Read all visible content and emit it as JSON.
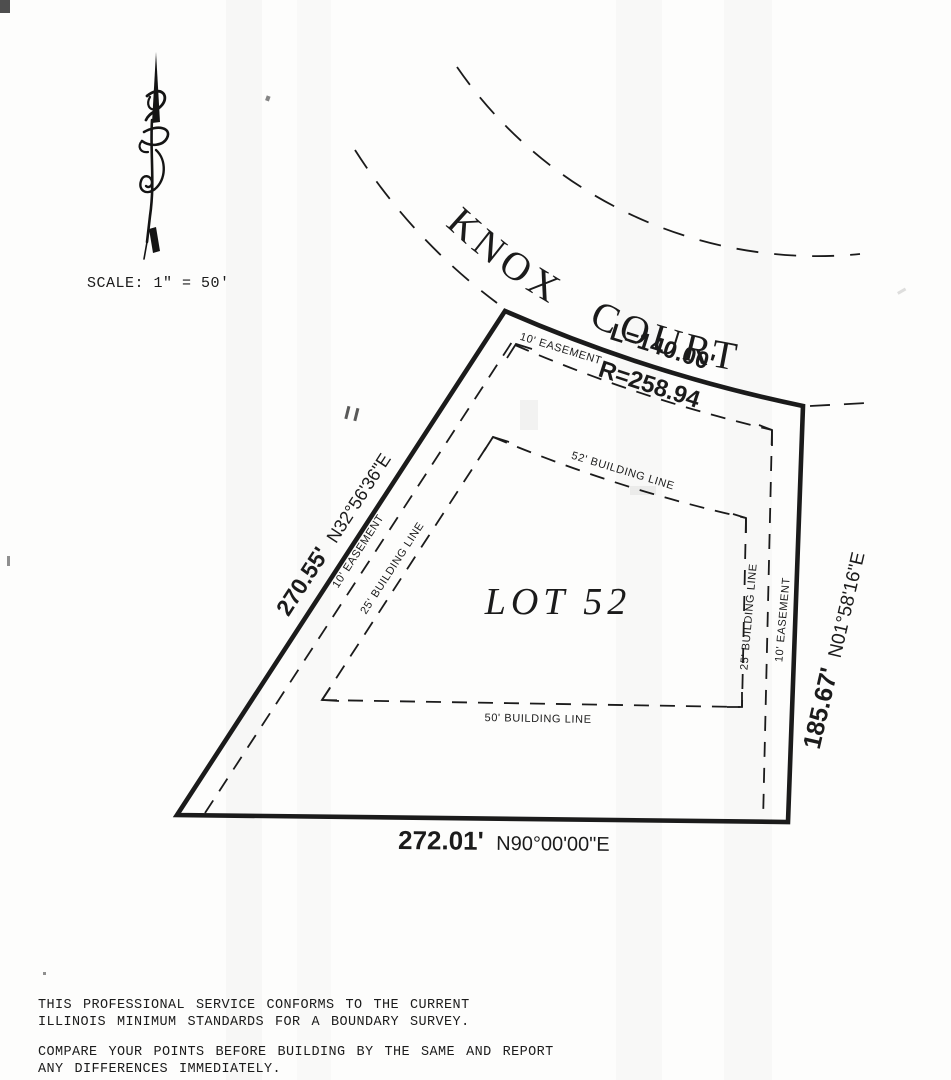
{
  "document": {
    "scale_label": "SCALE: 1\" = 50'",
    "street_name": "KNOX COURT",
    "lot_label": "LOT 52",
    "curve": {
      "arc_length": "L=140.00'",
      "radius": "R=258.94"
    },
    "boundaries": {
      "left": {
        "distance": "270.55'",
        "bearing": "N32°56'36\"E"
      },
      "right": {
        "distance": "185.67'",
        "bearing": "N01°58'16\"E"
      },
      "rear": {
        "distance": "272.01'",
        "bearing": "N90°00'00\"E"
      }
    },
    "easements": {
      "front": "10' EASEMENT",
      "left": "10' EASEMENT",
      "right": "10' EASEMENT"
    },
    "building_lines": {
      "front": "52' BUILDING LINE",
      "left": "25' BUILDING LINE",
      "right": "25' BUILDING LINE",
      "rear": "50' BUILDING LINE"
    },
    "notes": {
      "standards_1": "THIS PROFESSIONAL SERVICE CONFORMS TO THE CURRENT",
      "standards_2": "ILLINOIS MINIMUM STANDARDS FOR A BOUNDARY SURVEY.",
      "compare_1": "COMPARE YOUR POINTS BEFORE BUILDING BY THE SAME AND REPORT",
      "compare_2": "ANY DIFFERENCES IMMEDIATELY."
    }
  },
  "colors": {
    "ink": "#1b1b1b",
    "paper": "#fdfdfc"
  }
}
